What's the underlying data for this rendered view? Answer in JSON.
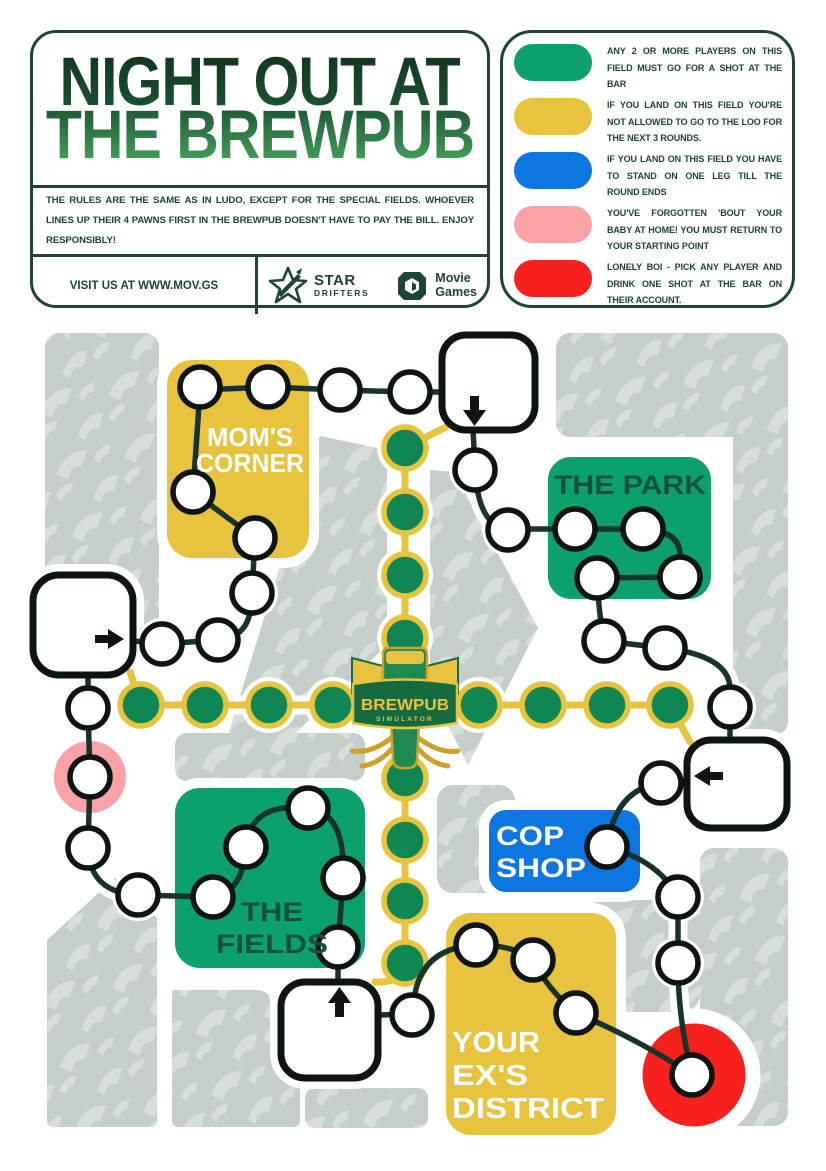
{
  "header": {
    "title": {
      "line1": "NIGHT OUT AT",
      "line2": "THE BREWPUB"
    },
    "rules": "THE RULES ARE THE SAME AS IN LUDO, EXCEPT FOR THE SPECIAL FIELDS. WHOEVER LINES UP THEIR 4 PAWNS FIRST IN THE BREWPUB DOESN'T HAVE TO PAY THE BILL. ENJOY RESPONSIBLY!",
    "visit": "VISIT US AT WWW.MOV.GS",
    "star_drifters": {
      "line1": "STAR",
      "line2": "DRIFTERS"
    },
    "movie_games": {
      "line1": "Movie",
      "line2": "Games"
    }
  },
  "legend": {
    "items": [
      {
        "name": "green-field",
        "color": "#0ca06a",
        "text": "ANY 2 OR MORE PLAYERS ON THIS FIELD MUST GO FOR A SHOT AT THE BAR"
      },
      {
        "name": "yellow-field",
        "color": "#e7c33e",
        "text": "IF YOU LAND ON THIS FIELD YOU'RE NOT ALLOWED TO GO TO THE LOO FOR THE NEXT 3 ROUNDS."
      },
      {
        "name": "blue-field",
        "color": "#0d76e0",
        "text": "IF YOU LAND ON THIS FIELD YOU HAVE TO STAND ON ONE LEG TILL THE ROUND ENDS"
      },
      {
        "name": "pink-field",
        "color": "#f9a3a8",
        "text": "YOU'VE FORGOTTEN 'BOUT YOUR BABY AT HOME! YOU MUST RETURN TO YOUR STARTING POINT"
      },
      {
        "name": "red-field",
        "color": "#f7211d",
        "text": "LONELY BOI - PICK ANY PLAYER AND DRINK ONE SHOT AT THE BAR ON THEIR ACCOUNT."
      }
    ]
  },
  "board": {
    "zones": {
      "moms_corner": {
        "line1": "MOM'S",
        "line2": "CORNER",
        "color": "#e7c33e",
        "text_color": "#ffffff"
      },
      "the_park": {
        "line1": "THE PARK",
        "color": "#0ca06a",
        "text_color": "#14533a"
      },
      "cop_shop": {
        "line1": "COP",
        "line2": "SHOP",
        "color": "#0d76e0",
        "text_color": "#ffffff"
      },
      "the_fields": {
        "line1": "THE",
        "line2": "FIELDS",
        "color": "#0ca06a",
        "text_color": "#14533a"
      },
      "your_exs_district": {
        "line1": "YOUR",
        "line2": "EX'S",
        "line3": "DISTRICT",
        "color": "#e7c33e",
        "text_color": "#ffffff"
      }
    },
    "center_logo": {
      "line1": "BREWPUB",
      "line2": "SIMULATOR"
    },
    "colors": {
      "green": "#0ca06a",
      "yellow": "#e7c33e",
      "blue": "#0d76e0",
      "pink": "#f9a3a8",
      "red": "#f7211d",
      "gold": "#e7c33e",
      "path_field_green": "#108653",
      "line": "#17332b",
      "ink": "#0d1411",
      "gray_block": "#c6cec9",
      "gray_pattern": "#d8ded9"
    }
  }
}
